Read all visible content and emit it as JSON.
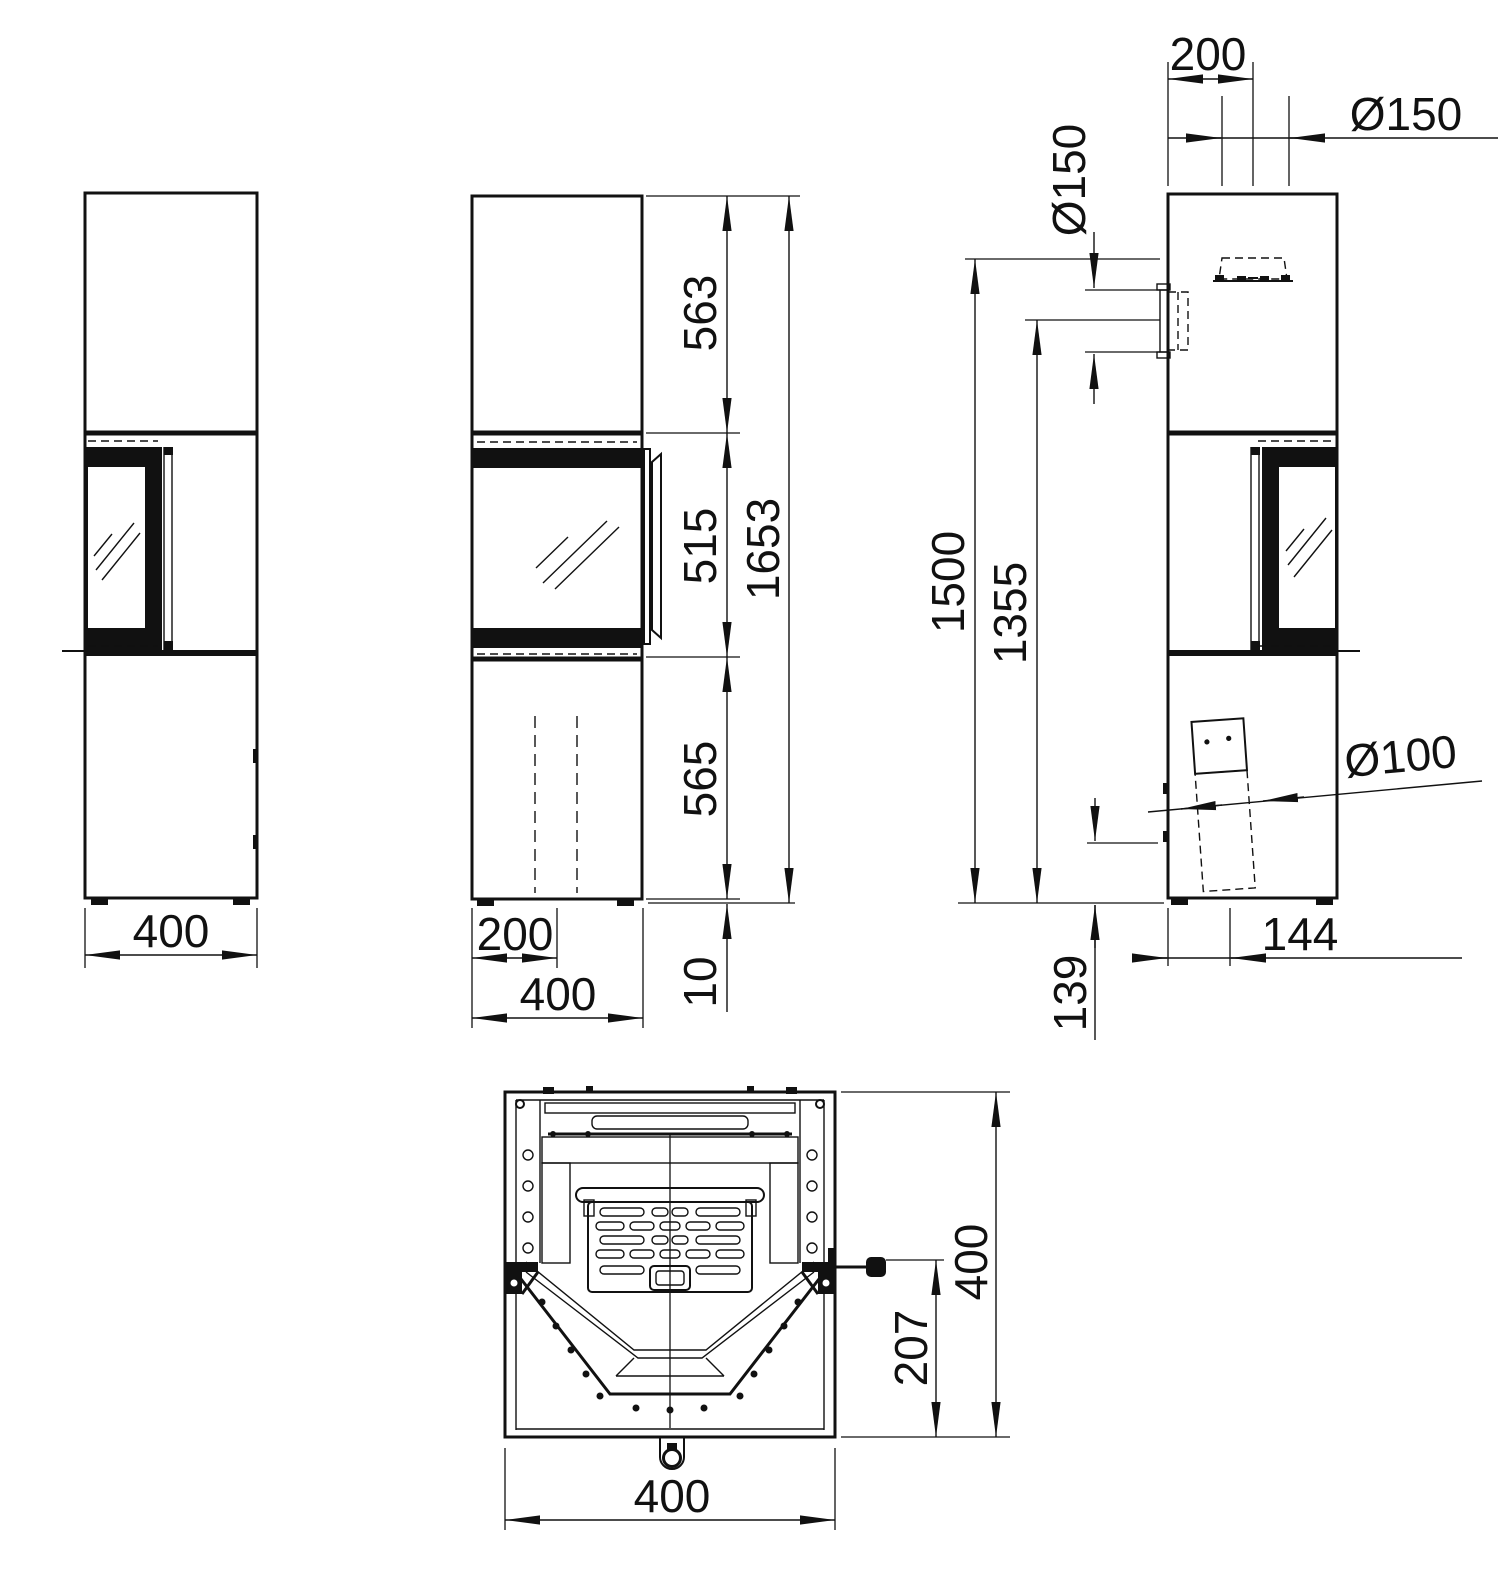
{
  "drawing": {
    "type": "stove-dimension-drawing",
    "ink_color": "#111111",
    "paper_color": "#ffffff",
    "views": {
      "left": {
        "width": "400"
      },
      "front": {
        "top_section_height": "563",
        "window_height": "515",
        "lower_section_height": "565",
        "total_height": "1653",
        "plinth_height": "10",
        "half_width": "200",
        "width": "400"
      },
      "right": {
        "flue_center_offset": "200",
        "top_flue_diameter": "Ø150",
        "rear_flue_diameter": "Ø150",
        "rear_flue_top_height": "1500",
        "rear_flue_bottom_height": "1355",
        "air_intake_diameter": "Ø100",
        "air_intake_offset": "144",
        "air_intake_height": "139"
      },
      "plan": {
        "width": "400",
        "depth": "400",
        "handle_depth": "207"
      }
    }
  }
}
